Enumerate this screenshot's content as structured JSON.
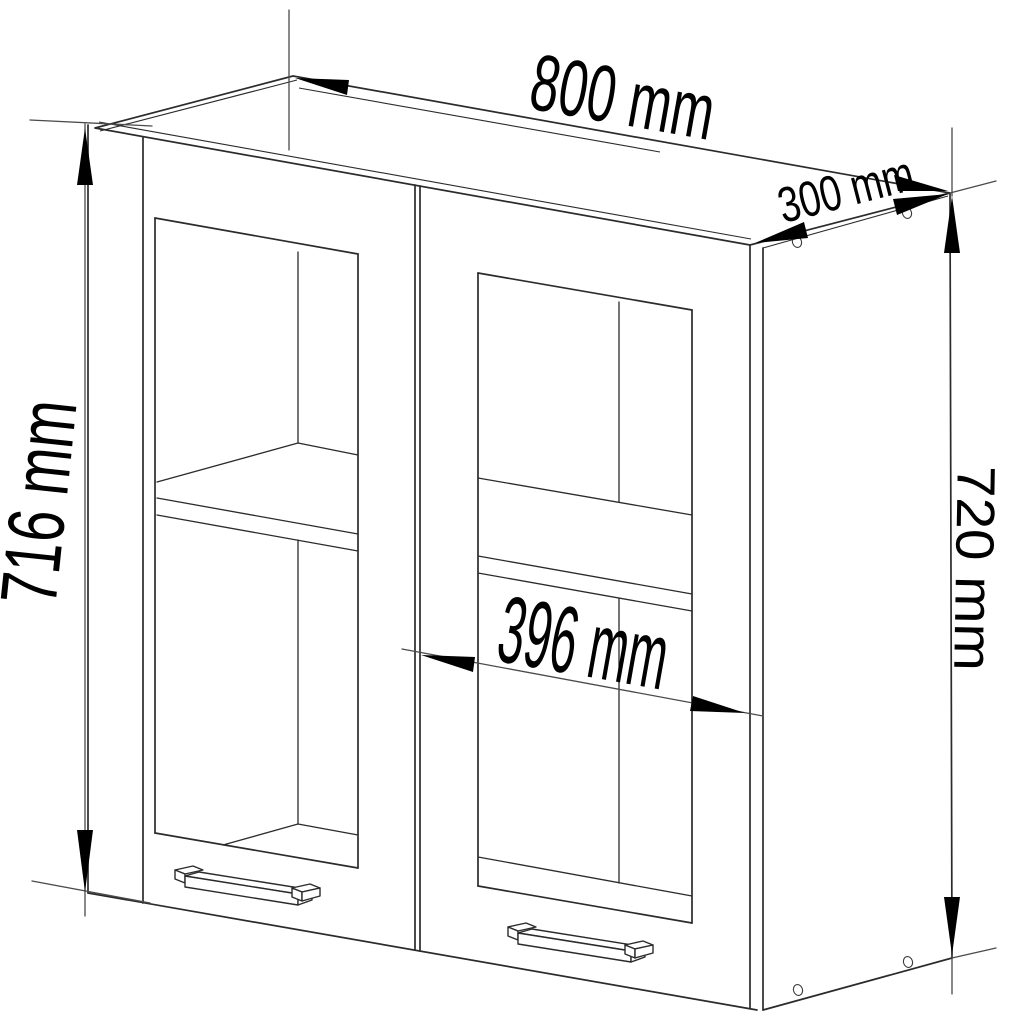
{
  "drawing": {
    "type": "furniture-dimension-diagram",
    "subject": "two-door glass wall cabinet",
    "unit": "mm",
    "dimensions": {
      "width": {
        "label": "800 mm",
        "value": 800
      },
      "depth": {
        "label": "300 mm",
        "value": 300
      },
      "front_height": {
        "label": "716 mm",
        "value": 716
      },
      "side_height": {
        "label": "720 mm",
        "value": 720
      },
      "door_width": {
        "label": "396 mm",
        "value": 396
      }
    },
    "colors": {
      "background": "#ffffff",
      "structure_line": "#2b2b2b",
      "dimension_line": "#4a4a4a",
      "label_text": "#000000"
    }
  }
}
